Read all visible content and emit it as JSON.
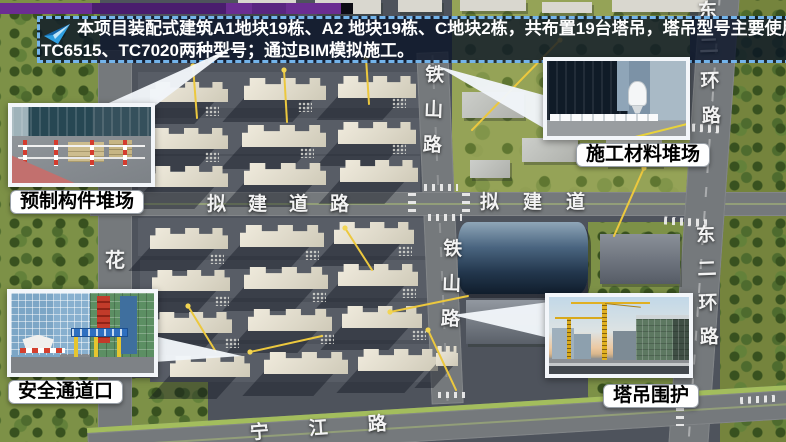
{
  "banner": {
    "line1": "本项目装配式建筑A1地块19栋、A2 地块19栋、C地块2栋，共布置19台塔吊，塔吊型号主要使用",
    "line2": "TC6515、TC7020两种型号；通过BIM模拟施工。"
  },
  "callouts": [
    {
      "label": "预制构件堆场"
    },
    {
      "label": "施工材料堆场"
    },
    {
      "label": "安全通道口"
    },
    {
      "label": "塔吊围护"
    }
  ],
  "roads": {
    "tieshan_upper": [
      "铁",
      "山",
      "路"
    ],
    "tieshan_lower": [
      "铁",
      "山",
      "路"
    ],
    "proposed_left": [
      "拟",
      "建",
      "道",
      "路"
    ],
    "proposed_right": [
      "拟",
      "建",
      "道"
    ],
    "hua": [
      "花"
    ],
    "east_ring_upper": [
      "东",
      "二",
      "环",
      "路"
    ],
    "east_ring_lower": [
      "东",
      "二",
      "环",
      "路"
    ],
    "river_road": [
      "宁",
      "江",
      "路"
    ]
  },
  "icons": {
    "banner_arrow": "paper-plane"
  },
  "colors": {
    "banner_border": "#74b4ea",
    "banner_bg_rgba": "rgba(7,17,37,0.78)",
    "accent_bar": "#6b2d92",
    "crane_yellow": "#ecc83e",
    "label_bg": "#ffffff",
    "label_text": "#000000",
    "road_text": "#f3f3f3"
  }
}
